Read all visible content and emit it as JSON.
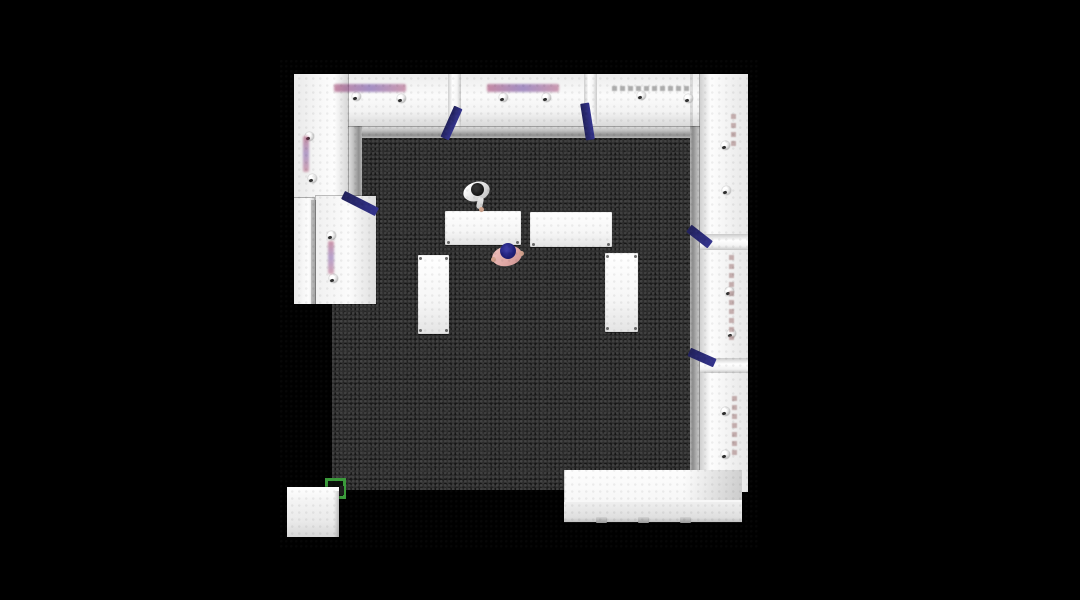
{
  "scene": {
    "description": "Top-down 3D render of an exhibition booth on a black backdrop",
    "view": "plan / bird's-eye",
    "background_color": "#000000"
  },
  "palette": {
    "backdrop": "#000000",
    "wall_white": "#f6f6f6",
    "carpet_dark": "#2c2c2c",
    "skirting_gray": "#a8a8a8",
    "accent_navy": "#2b2b78",
    "accent_green": "#3a9a3a",
    "brand_magenta": "#96285a",
    "brand_purple": "#5a3296",
    "person_a_hair": "#141414",
    "person_a_top": "#e9e9e7",
    "person_b_hair": "#20207a",
    "person_b_top": "#e0a9a6",
    "skin": "#cfa28b"
  },
  "inventory": {
    "walls": [
      "top wall with three graphic panels",
      "right wall with three panels",
      "upper-left wall panel",
      "low left counter wall with navy edge"
    ],
    "tables": {
      "count": 4,
      "horizontal": 2,
      "vertical": 2
    },
    "people": {
      "count": 2
    },
    "spotlights": {
      "count": 16
    },
    "navy_braces": {
      "count": 5
    },
    "counters": [
      "bottom-right reception counter",
      "bottom-left cube podium"
    ],
    "floor_marker": "green electrical floor box at carpet corner"
  }
}
